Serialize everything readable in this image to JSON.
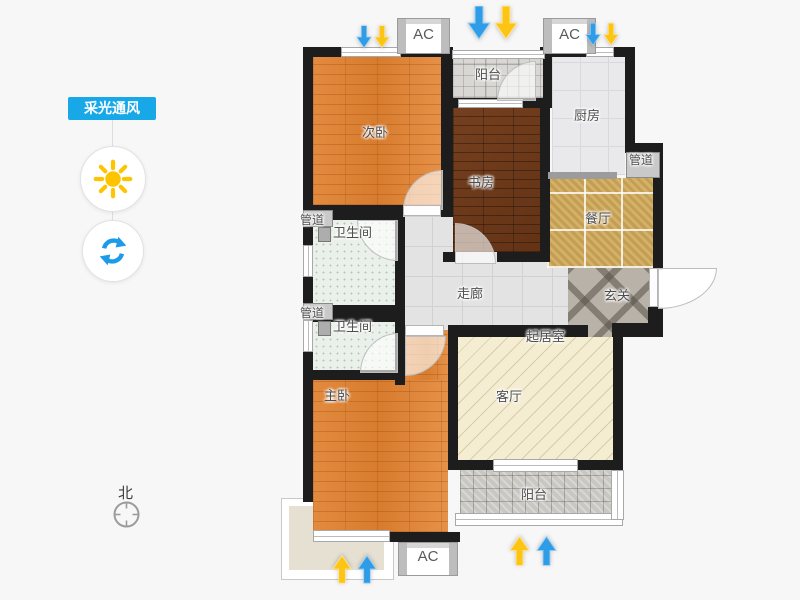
{
  "app": {
    "background": "#f7f7f7"
  },
  "toolbar": {
    "tooltip": "采光通风",
    "tooltip_bg": "#18a8e8",
    "buttons": [
      {
        "name": "daylight",
        "icon": "sun-icon",
        "color": "#ffc400"
      },
      {
        "name": "ventilation",
        "icon": "refresh-icon",
        "color": "#1e9be8"
      }
    ]
  },
  "compass": {
    "north": "北"
  },
  "floorplan": {
    "labels": {
      "bedroom2": "次卧",
      "balcony": "阳台",
      "kitchen": "厨房",
      "pipe": "管道",
      "study": "书房",
      "dining": "餐厅",
      "foyer": "玄关",
      "corridor": "走廊",
      "bathroom": "卫生间",
      "master": "主卧",
      "living": "起居室",
      "parlor": "客厅",
      "ac": "AC"
    },
    "arrows": {
      "light_color": "#fdc513",
      "wind_color": "#2f9ce8"
    }
  }
}
